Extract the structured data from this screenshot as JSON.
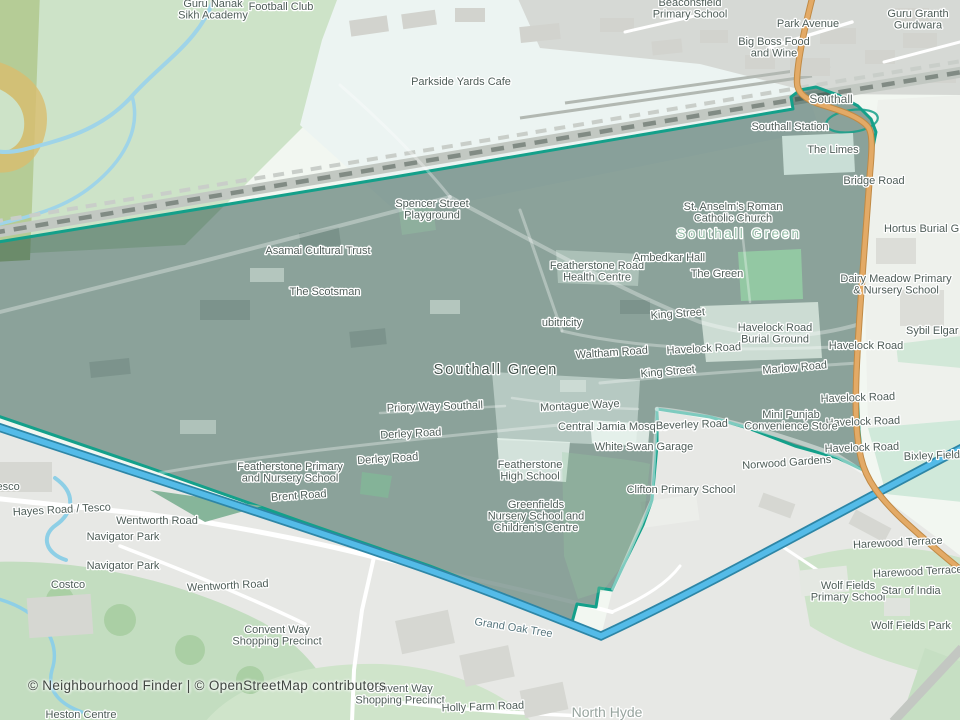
{
  "map": {
    "attribution": "© Neighbourhood Finder | © OpenStreetMap contributors",
    "colors": {
      "boundary_stroke": "#14a08a",
      "boundary_fill": "rgba(28,70,58,0.48)",
      "canal_fill": "#54bbe8",
      "canal_casing": "#2e86a6",
      "primary_road": "#e3aa66",
      "primary_road_casing": "#c08a45",
      "railway": "#818b84",
      "land": "#f2f7f1",
      "urban": "#e7e8e5",
      "park_green": "#cfe4ca",
      "label_text": "#4e5d58"
    },
    "labels": [
      {
        "name": "guru-nanak-academy-label",
        "lines": [
          "Guru Nanak",
          "Sikh Academy"
        ],
        "x": 213,
        "y": 7
      },
      {
        "name": "football-club-label",
        "text": "Football Club",
        "x": 281,
        "y": 10
      },
      {
        "name": "parkside-yards-cafe-label",
        "text": "Parkside Yards Cafe",
        "x": 461,
        "y": 85
      },
      {
        "name": "beaconsfield-primary-school-label",
        "lines": [
          "Beaconsfield",
          "Primary School"
        ],
        "x": 690,
        "y": 6
      },
      {
        "name": "park-avenue-label",
        "text": "Park Avenue",
        "x": 808,
        "y": 27
      },
      {
        "name": "big-boss-food-and-wine-label",
        "lines": [
          "Big Boss Food",
          "and Wine"
        ],
        "x": 774,
        "y": 45
      },
      {
        "name": "guru-granth-gurdwara-label",
        "lines": [
          "Guru Granth",
          "Gurdwara"
        ],
        "x": 918,
        "y": 17
      },
      {
        "name": "southall-place-label",
        "text": "Southall",
        "x": 831,
        "y": 103,
        "size": 12,
        "color": "#5a6863"
      },
      {
        "name": "southall-station-label",
        "text": "Southall Station",
        "x": 790,
        "y": 130
      },
      {
        "name": "the-limes-label",
        "text": "The Limes",
        "x": 833,
        "y": 153
      },
      {
        "name": "bridge-road-label",
        "text": "Bridge Road",
        "x": 874,
        "y": 184
      },
      {
        "name": "hortus-burial-ground-label",
        "text": "Hortus Burial Ground",
        "x": 884,
        "y": 232,
        "anchor": "start"
      },
      {
        "name": "spencer-street-playground-label",
        "lines": [
          "Spencer Street",
          "Playground"
        ],
        "x": 432,
        "y": 207
      },
      {
        "name": "asamai-cultural-trust-label",
        "text": "Asamai Cultural Trust",
        "x": 318,
        "y": 254
      },
      {
        "name": "the-scotsman-label",
        "text": "The Scotsman",
        "x": 325,
        "y": 295
      },
      {
        "name": "st-anselms-church-label",
        "lines": [
          "St. Anselm's Roman",
          "Catholic Church"
        ],
        "x": 733,
        "y": 210
      },
      {
        "name": "southall-green-area-label",
        "text": "Southall Green",
        "x": 739,
        "y": 238,
        "size": 13.5,
        "spacing": 2.5,
        "color": "rgba(134,181,155,0.9)"
      },
      {
        "name": "featherstone-health-centre-label",
        "lines": [
          "Featherstone Road",
          "Health Centre"
        ],
        "x": 597,
        "y": 269
      },
      {
        "name": "ambedkar-hall-label",
        "text": "Ambedkar Hall",
        "x": 669,
        "y": 261
      },
      {
        "name": "the-green-label",
        "text": "The Green",
        "x": 717,
        "y": 277
      },
      {
        "name": "ubitricity-label",
        "text": "ubitricity",
        "x": 562,
        "y": 326
      },
      {
        "name": "king-street-upper-label",
        "text": "King Street",
        "x": 678,
        "y": 317,
        "rotate": -4
      },
      {
        "name": "havelock-burial-ground-label",
        "lines": [
          "Havelock Road",
          "Burial Ground"
        ],
        "x": 775,
        "y": 331
      },
      {
        "name": "waltham-road-label",
        "text": "Waltham Road",
        "x": 612,
        "y": 356,
        "rotate": -4
      },
      {
        "name": "havelock-road-mid-label",
        "text": "Havelock Road",
        "x": 704,
        "y": 352,
        "rotate": -3
      },
      {
        "name": "king-street-lower-label",
        "text": "King Street",
        "x": 668,
        "y": 375,
        "rotate": -5
      },
      {
        "name": "marlow-road-label",
        "text": "Marlow Road",
        "x": 795,
        "y": 371,
        "rotate": -5
      },
      {
        "name": "dairy-meadow-school-label",
        "lines": [
          "Dairy Meadow Primary",
          "& Nursery School"
        ],
        "x": 896,
        "y": 282
      },
      {
        "name": "sybil-elgar-school-label",
        "text": "Sybil Elgar School",
        "x": 906,
        "y": 334,
        "anchor": "start"
      },
      {
        "name": "havelock-road-e1-label",
        "text": "Havelock Road",
        "x": 866,
        "y": 349
      },
      {
        "name": "havelock-road-e2-label",
        "text": "Havelock Road",
        "x": 858,
        "y": 401,
        "rotate": -2
      },
      {
        "name": "havelock-road-e3-label",
        "text": "Havelock Road",
        "x": 863,
        "y": 425,
        "rotate": -2
      },
      {
        "name": "havelock-road-e4-label",
        "text": "Havelock Road",
        "x": 862,
        "y": 451,
        "rotate": -2
      },
      {
        "name": "southall-green-main-label",
        "text": "Southall Green",
        "x": 496,
        "y": 374,
        "size": 14.5,
        "spacing": 2,
        "color": "#42524b"
      },
      {
        "name": "priory-way-southall-label",
        "text": "Priory Way Southall",
        "x": 435,
        "y": 410,
        "rotate": -2
      },
      {
        "name": "montague-waye-label",
        "text": "Montague Waye",
        "x": 580,
        "y": 409,
        "rotate": -3
      },
      {
        "name": "derley-road-west-label",
        "text": "Derley Road",
        "x": 411,
        "y": 437,
        "rotate": -3
      },
      {
        "name": "central-jamia-mosque-label",
        "text": "Central Jamia Mosque",
        "x": 613,
        "y": 430
      },
      {
        "name": "beverley-road-label",
        "text": "Beverley Road",
        "x": 692,
        "y": 428,
        "rotate": -2
      },
      {
        "name": "mini-punjab-store-label",
        "lines": [
          "Mini Punjab",
          "Convenience Store"
        ],
        "x": 791,
        "y": 418
      },
      {
        "name": "white-swan-garage-label",
        "text": "White Swan Garage",
        "x": 644,
        "y": 450
      },
      {
        "name": "norwood-gardens-label",
        "text": "Norwood Gardens",
        "x": 787,
        "y": 466,
        "rotate": -4
      },
      {
        "name": "bixley-field-label",
        "text": "Bixley Field",
        "x": 932,
        "y": 459,
        "rotate": -2
      },
      {
        "name": "clifton-primary-school-label",
        "text": "Clifton Primary School",
        "x": 681,
        "y": 493
      },
      {
        "name": "featherstone-primary-school-label",
        "lines": [
          "Featherstone Primary",
          "and Nursery School"
        ],
        "x": 290,
        "y": 470
      },
      {
        "name": "brent-road-label",
        "text": "Brent Road",
        "x": 299,
        "y": 499,
        "rotate": -4
      },
      {
        "name": "derley-road-east-label",
        "text": "Derley Road",
        "x": 388,
        "y": 462,
        "rotate": -4
      },
      {
        "name": "featherstone-high-school-label",
        "lines": [
          "Featherstone",
          "High School"
        ],
        "x": 530,
        "y": 468
      },
      {
        "name": "greenfields-nursery-label",
        "lines": [
          "Greenfields",
          "Nursery School and",
          "Children's Centre"
        ],
        "x": 536,
        "y": 508
      },
      {
        "name": "tesco-clipped-label",
        "text": "Tesco",
        "x": -9,
        "y": 490,
        "anchor": "start"
      },
      {
        "name": "hayes-road-tesco-label",
        "text": "Hayes Road / Tesco",
        "x": 62,
        "y": 513,
        "rotate": -3
      },
      {
        "name": "wentworth-road-north-label",
        "text": "Wentworth Road",
        "x": 157,
        "y": 524
      },
      {
        "name": "navigator-park-1-label",
        "text": "Navigator Park",
        "x": 123,
        "y": 540
      },
      {
        "name": "navigator-park-2-label",
        "text": "Navigator Park",
        "x": 123,
        "y": 569
      },
      {
        "name": "costco-label",
        "text": "Costco",
        "x": 68,
        "y": 588
      },
      {
        "name": "wentworth-road-south-label",
        "text": "Wentworth Road",
        "x": 228,
        "y": 589,
        "rotate": -3
      },
      {
        "name": "convent-way-precinct-north-label",
        "lines": [
          "Convent Way",
          "Shopping Precinct"
        ],
        "x": 277,
        "y": 633
      },
      {
        "name": "grand-oak-tree-label",
        "text": "Grand Oak Tree",
        "x": 513,
        "y": 631,
        "rotate": 9,
        "color": "#57767e"
      },
      {
        "name": "harewood-terrace-1-label",
        "text": "Harewood Terrace",
        "x": 898,
        "y": 546,
        "rotate": -3
      },
      {
        "name": "harewood-terrace-2-label",
        "text": "Harewood Terrace",
        "x": 918,
        "y": 575,
        "rotate": -3
      },
      {
        "name": "wolf-fields-primary-school-label",
        "lines": [
          "Wolf Fields",
          "Primary School"
        ],
        "x": 848,
        "y": 589
      },
      {
        "name": "star-of-india-label",
        "text": "Star of India",
        "x": 911,
        "y": 594
      },
      {
        "name": "wolf-fields-park-label",
        "text": "Wolf Fields Park",
        "x": 911,
        "y": 629
      },
      {
        "name": "convent-way-precinct-south-label",
        "lines": [
          "Convent Way",
          "Shopping Precinct"
        ],
        "x": 400,
        "y": 692
      },
      {
        "name": "holly-farm-road-label",
        "text": "Holly Farm Road",
        "x": 483,
        "y": 710,
        "rotate": -2
      },
      {
        "name": "north-hyde-label",
        "text": "North Hyde",
        "x": 607,
        "y": 717,
        "size": 14,
        "color": "#97a49e"
      },
      {
        "name": "heston-centre-label",
        "text": "Heston Centre",
        "x": 81,
        "y": 718
      }
    ]
  }
}
